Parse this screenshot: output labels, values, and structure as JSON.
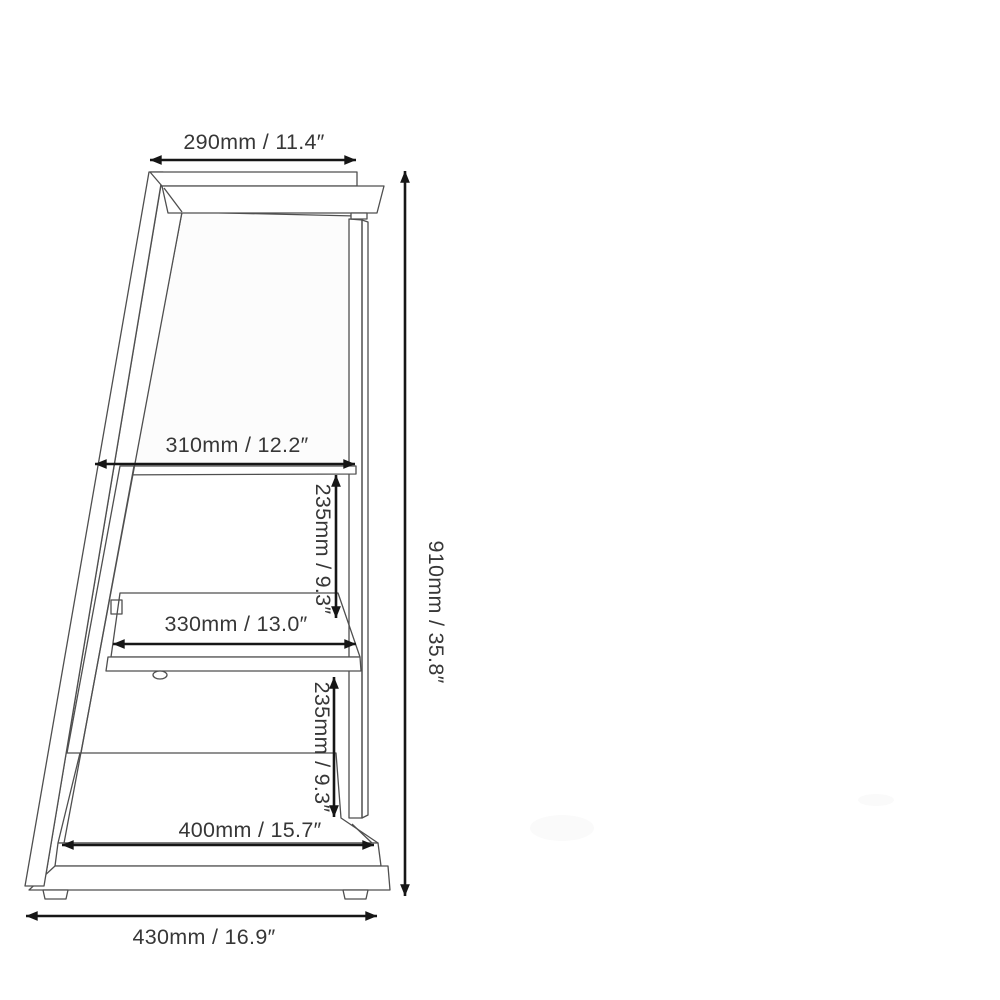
{
  "figure": {
    "kind": "product-dimension-diagram",
    "subject": "three-tier ladder shelf side view"
  },
  "dimensions": {
    "top_width": {
      "label": "290mm / 11.4″",
      "mm": 290,
      "inches": 11.4
    },
    "shelf1_width": {
      "label": "310mm / 12.2″",
      "mm": 310,
      "inches": 12.2
    },
    "gap_upper": {
      "label": "235mm / 9.3″",
      "mm": 235,
      "inches": 9.3
    },
    "shelf2_width": {
      "label": "330mm / 13.0″",
      "mm": 330,
      "inches": 13.0
    },
    "gap_lower": {
      "label": "235mm / 9.3″",
      "mm": 235,
      "inches": 9.3
    },
    "shelf3_width": {
      "label": "400mm / 15.7″",
      "mm": 400,
      "inches": 15.7
    },
    "base_width": {
      "label": "430mm / 16.9″",
      "mm": 430,
      "inches": 16.9
    },
    "height": {
      "label": "910mm / 35.8″",
      "mm": 910,
      "inches": 35.8
    }
  },
  "colors": {
    "background": "#ffffff",
    "line_art": "#4f4f4f",
    "dimension_line": "#161616",
    "dimension_text": "#373737",
    "hatch": "#d7d7d7"
  }
}
